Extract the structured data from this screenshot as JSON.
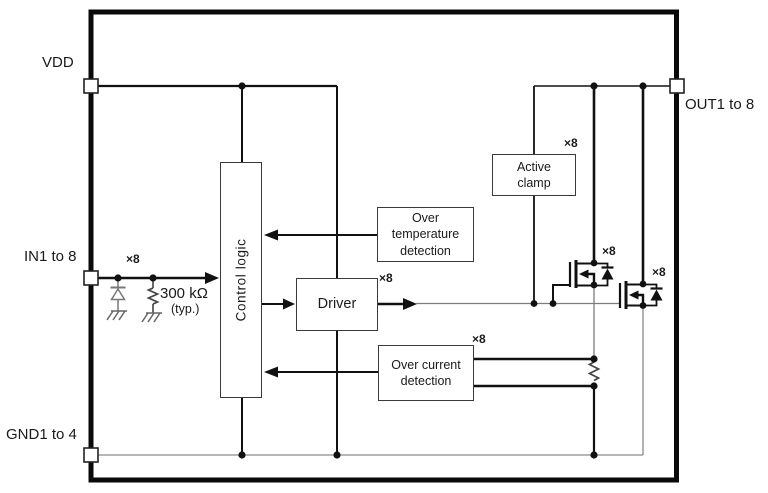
{
  "colors": {
    "line": "#111111",
    "thin_line": "#7d7d7d",
    "box_border": "#3a3a3a",
    "background": "#ffffff",
    "text": "#1a1a1a"
  },
  "pins": {
    "vdd": {
      "label": "VDD"
    },
    "in": {
      "label": "IN1 to 8"
    },
    "gnd": {
      "label": "GND1 to 4"
    },
    "out": {
      "label": "OUT1 to 8"
    }
  },
  "blocks": {
    "control_logic": {
      "label": "Control  logic"
    },
    "driver": {
      "label": "Driver"
    },
    "over_temperature": {
      "label": "Over temperature\ndetection"
    },
    "over_current": {
      "label": "Over current\ndetection"
    },
    "active_clamp": {
      "label": "Active\nclamp"
    }
  },
  "components": {
    "input_pulldown_resistor": {
      "value": "300 kΩ",
      "qualifier": "(typ.)"
    }
  },
  "multipliers": {
    "input": "×8",
    "driver_output": "×8",
    "active_clamp": "×8",
    "over_current": "×8",
    "sense_fet": "×8",
    "output_fet": "×8"
  }
}
